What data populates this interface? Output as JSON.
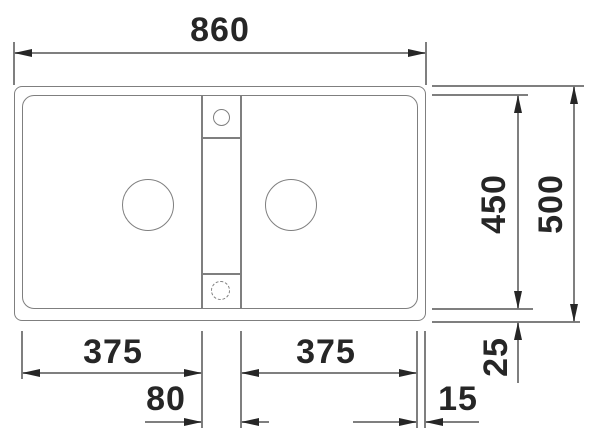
{
  "colors": {
    "line": "#7f7f7f",
    "ink": "#262626",
    "background": "#ffffff"
  },
  "drawing": {
    "type": "sink-installation-dimension-drawing",
    "total_width": "860",
    "total_depth": "500",
    "inner_depth": "450",
    "left_bowl_width": "375",
    "right_bowl_width": "375",
    "divider_width": "80",
    "side_rim": "15",
    "bottom_rim": "25"
  }
}
